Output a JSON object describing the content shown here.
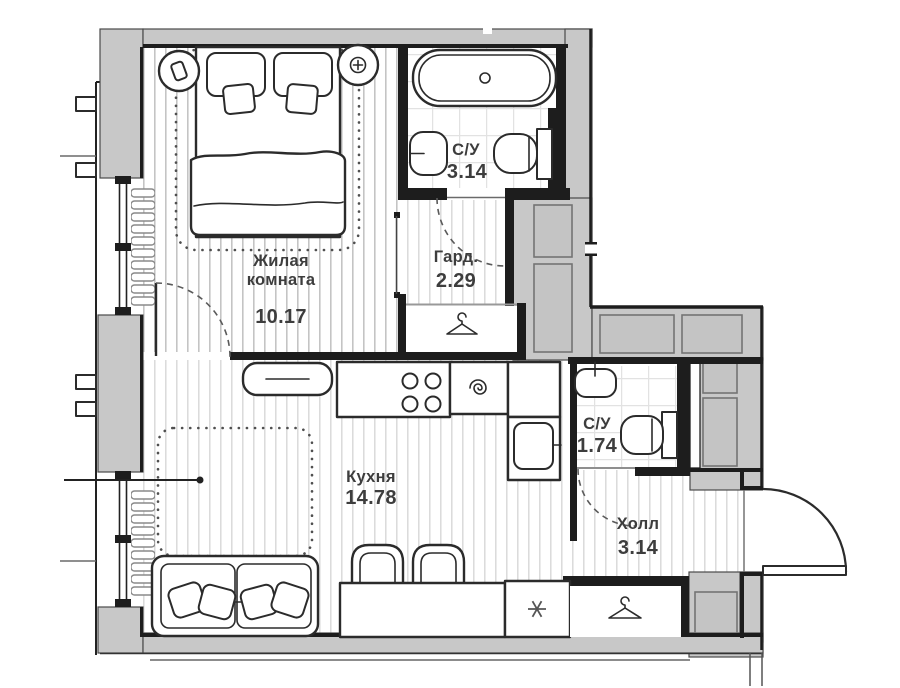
{
  "rooms": {
    "living": {
      "line1": "Жилая",
      "line2": "комната",
      "area": "10.17"
    },
    "bath_top": {
      "name": "С/У",
      "area": "3.14"
    },
    "wardrobe": {
      "name": "Гард.",
      "area": "2.29"
    },
    "kitchen": {
      "name": "Кухня",
      "area": "14.78"
    },
    "bath_hall": {
      "name": "С/У",
      "area": "1.74"
    },
    "hall": {
      "name": "Холл",
      "area": "3.14"
    }
  },
  "icons": {
    "wardrobe_closet": "hanger-icon",
    "hall_closet": "hanger-icon",
    "fridge": "snowflake-icon",
    "kitchen_sink": "spiral-drain-icon",
    "bathtub_drain": "drain-circle-icon",
    "nightstand_left": "phone-icon",
    "nightstand_right": "dial-plus-icon"
  },
  "colors": {
    "wall_fill": "#c8c8c8",
    "wall_line": "#1d1d1d",
    "furniture_line": "#2b2b2b",
    "floor_stripe": "#c4c4c4",
    "floor_stripe_light": "#d7d7d7",
    "tile_line": "#e2e2e2",
    "label_text": "#3d3d3d",
    "dash_line": "#5a5a5a"
  }
}
